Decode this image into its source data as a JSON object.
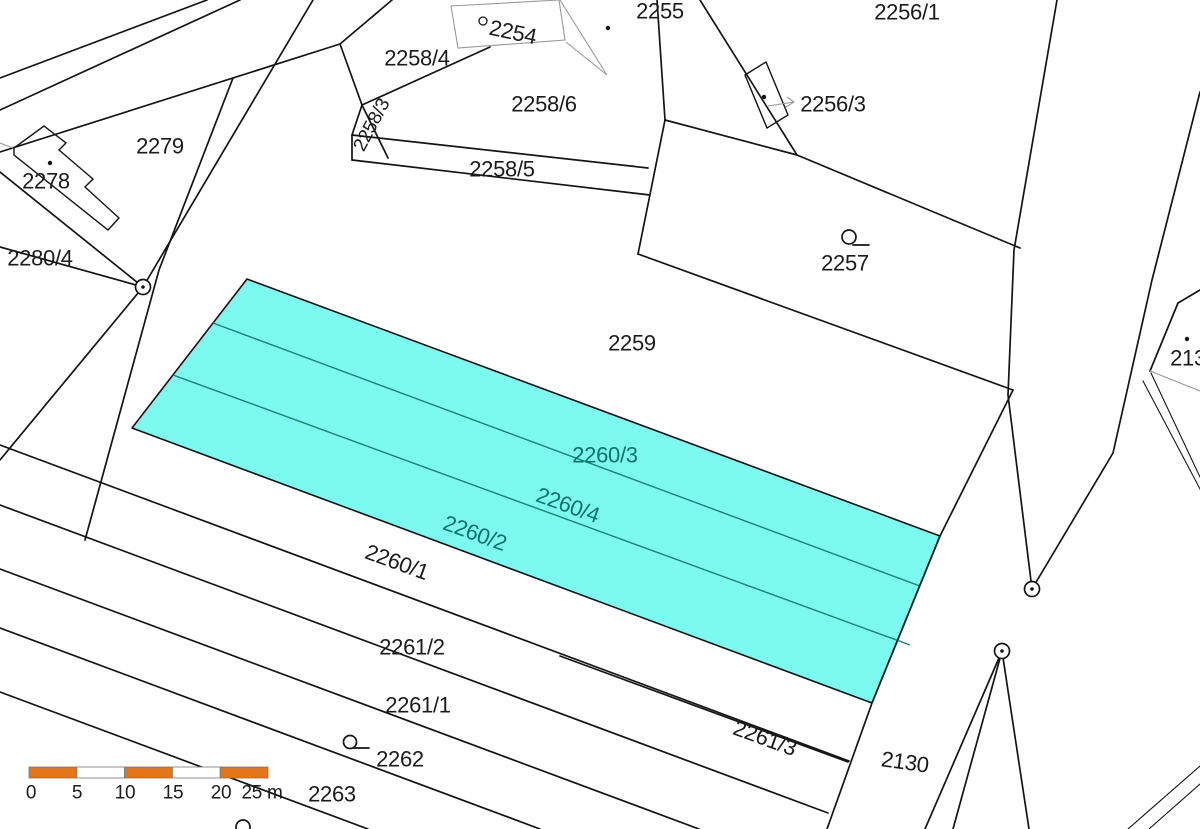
{
  "map": {
    "type": "cadastral-parcel-map",
    "highlight_fill": "#7dfaef",
    "highlight_label_color": "#0b7169",
    "boundary_color": "#141414",
    "scalebar_orange": "#e4761a",
    "highlighted_parcels": [
      "2260/3",
      "2260/4",
      "2260/2"
    ]
  },
  "labels": {
    "p2254": "2254",
    "p2255": "2255",
    "p2256_1": "2256/1",
    "p2256_3": "2256/3",
    "p2257": "2257",
    "p2258_4": "2258/4",
    "p2258_6": "2258/6",
    "p2258_5": "2258/5",
    "p2258_3": "2258/3",
    "p2259": "2259",
    "p2279": "2279",
    "p2278": "2278",
    "p2280_4": "2280/4",
    "p2260_3": "2260/3",
    "p2260_4": "2260/4",
    "p2260_2": "2260/2",
    "p2260_1": "2260/1",
    "p2261_2": "2261/2",
    "p2261_1": "2261/1",
    "p2261_3": "2261/3",
    "p2262": "2262",
    "p2263": "2263",
    "p2130": "2130",
    "p213x": "213"
  },
  "scalebar": {
    "t0": "0",
    "t5": "5",
    "t10": "10",
    "t15": "15",
    "t20": "20",
    "t25": "25 m"
  }
}
